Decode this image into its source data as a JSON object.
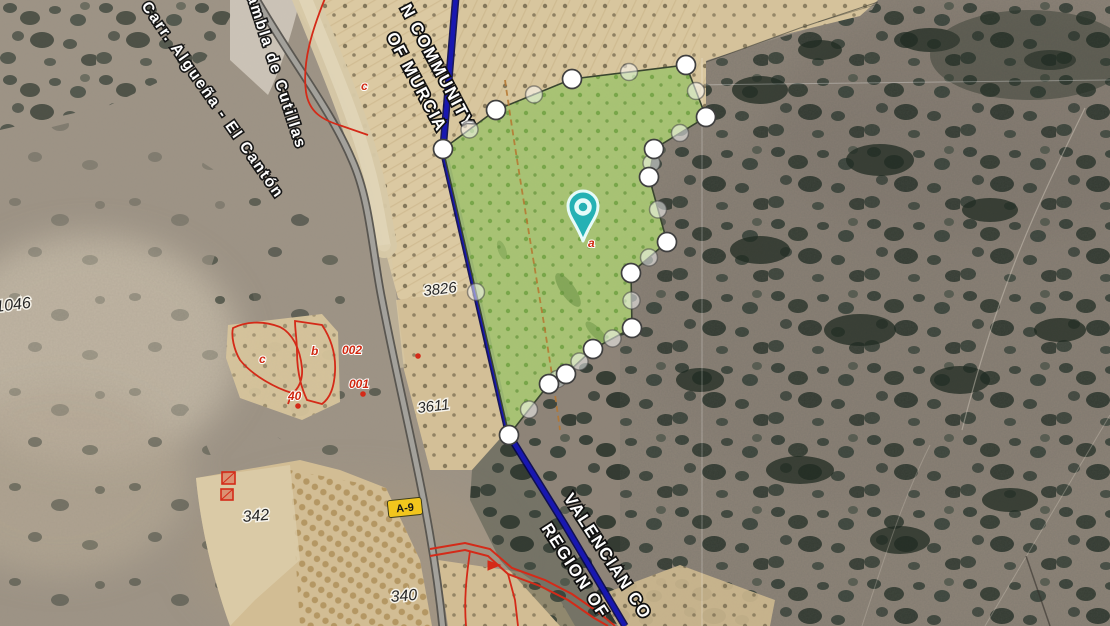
{
  "labels": {
    "boundary": {
      "top1": "N COMMUNITY",
      "top2": "OF MURCIA",
      "bottom1": "VALENCIAN CO",
      "bottom2": "REGION OF"
    },
    "roads": {
      "carr": "Carr. Algueña - El Cantón",
      "rambla": "Rambla de Cutillas"
    },
    "road_badge": "A-9"
  },
  "cadastral": {
    "numbers": [
      {
        "text": "3826",
        "x": 424,
        "y": 296,
        "rot": -7,
        "size": 15
      },
      {
        "text": "3611",
        "x": 418,
        "y": 413,
        "rot": -7,
        "size": 15
      },
      {
        "text": "1046",
        "x": -4,
        "y": 312,
        "rot": -7,
        "size": 16
      },
      {
        "text": "340",
        "x": 391,
        "y": 602,
        "rot": -5,
        "size": 16
      },
      {
        "text": "342",
        "x": 243,
        "y": 522,
        "rot": -5,
        "size": 16
      }
    ],
    "red_labels": [
      {
        "text": "002",
        "x": 342,
        "y": 354
      },
      {
        "text": "001",
        "x": 349,
        "y": 388
      },
      {
        "text": "40",
        "x": 288,
        "y": 400
      },
      {
        "text": "b",
        "x": 311,
        "y": 355
      },
      {
        "text": "c",
        "x": 259,
        "y": 363
      },
      {
        "text": "c",
        "x": 361,
        "y": 90
      },
      {
        "text": "a",
        "x": 588,
        "y": 247
      }
    ],
    "red_dots": [
      [
        418,
        356
      ],
      [
        298,
        406
      ],
      [
        363,
        394
      ]
    ]
  },
  "parcel": {
    "fill": "#a9c872",
    "outline": "#39452f",
    "vertices": [
      [
        443,
        149
      ],
      [
        496,
        110
      ],
      [
        572,
        79
      ],
      [
        686,
        65
      ],
      [
        706,
        117
      ],
      [
        654,
        149
      ],
      [
        649,
        177
      ],
      [
        667,
        242
      ],
      [
        631,
        273
      ],
      [
        632,
        328
      ],
      [
        593,
        349
      ],
      [
        566,
        374
      ],
      [
        549,
        384
      ],
      [
        509,
        435
      ]
    ],
    "pin": {
      "x": 583,
      "y": 241,
      "color": "#25b1b4"
    }
  },
  "colors": {
    "boundary_blue": "#1817b0",
    "cadastral_red": "#d42a18",
    "road_badge_yellow": "#f2c61d"
  }
}
